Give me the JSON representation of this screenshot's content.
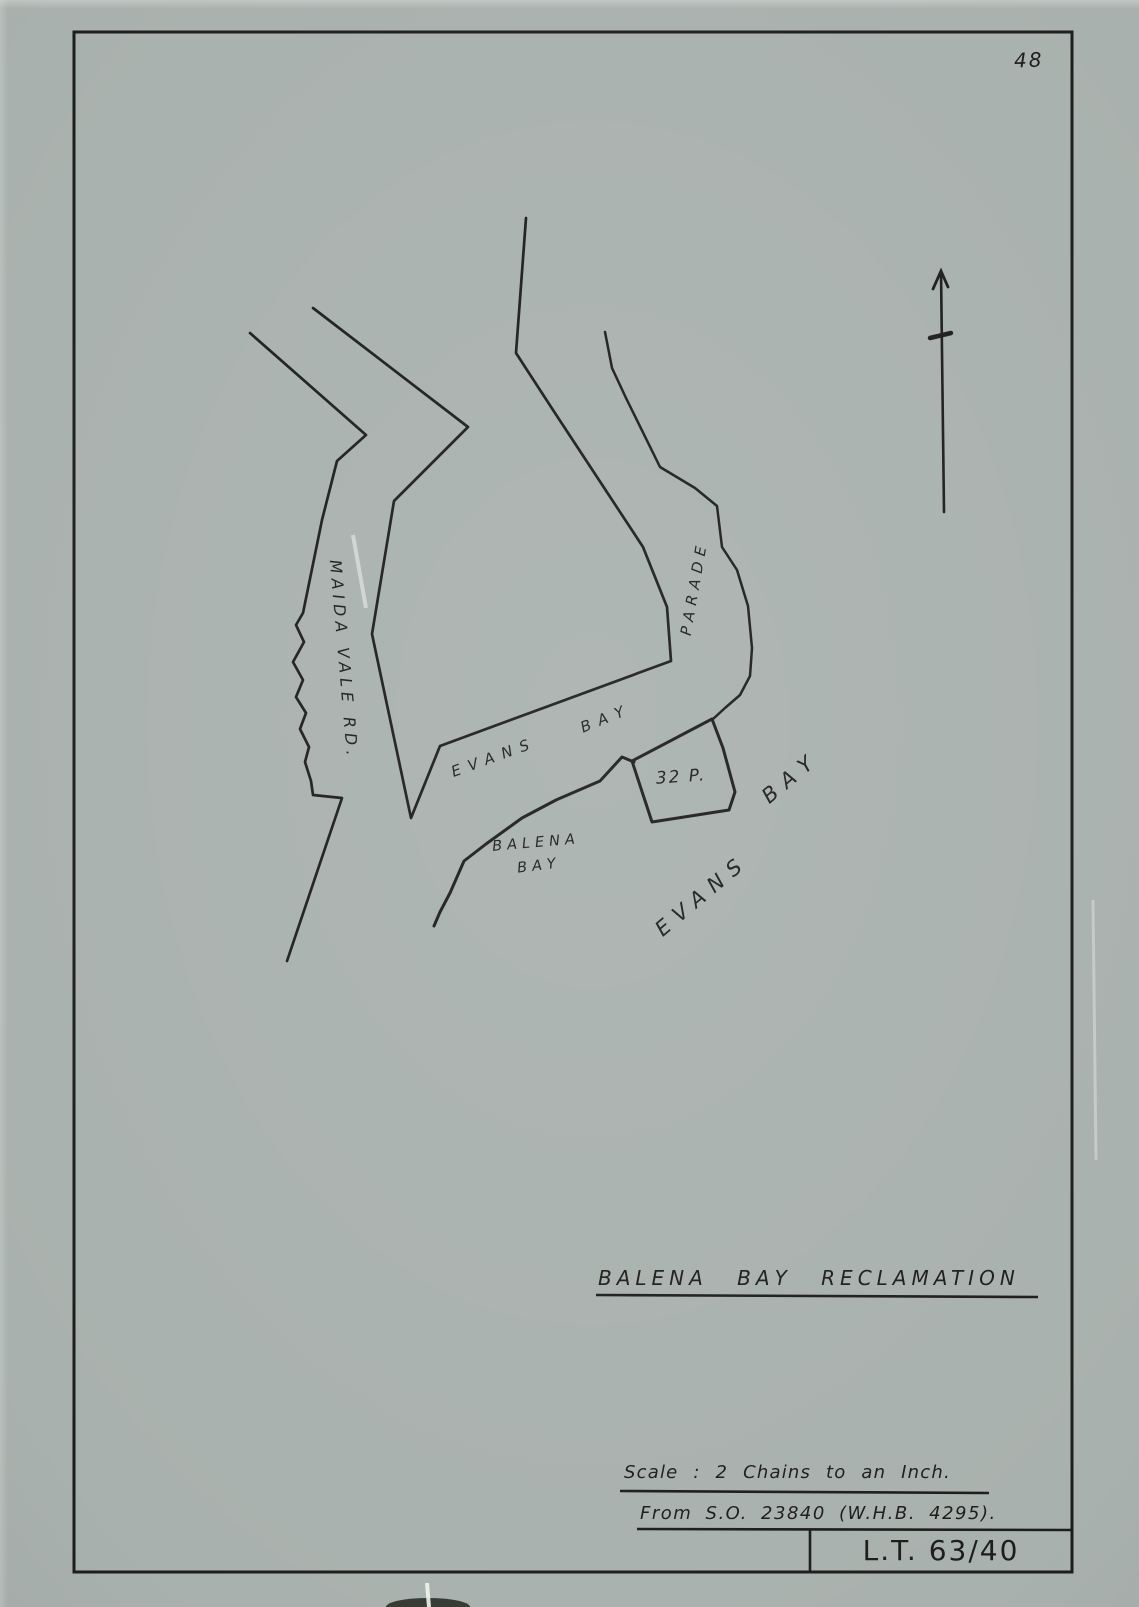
{
  "page": {
    "number": "48"
  },
  "map": {
    "labels": {
      "maida_vale_rd": "MAIDA VALE RD.",
      "evans_bay_shore_evans": "EVANS",
      "evans_bay_shore_bay": "BAY",
      "parade": "PARADE",
      "parcel_32p": "32 P.",
      "balena_bay_line1": "BALENA",
      "balena_bay_line2": "BAY",
      "evans_bay_water_evans": "EVANS",
      "evans_bay_water_bay": "BAY"
    },
    "icons": {
      "north_arrow": "north-arrow-icon"
    }
  },
  "title_block": {
    "title": "BALENA BAY RECLAMATION",
    "scale": "Scale : 2 Chains to an Inch.",
    "source": "From S.O. 23840 (W.H.B. 4295).",
    "plan_ref": "L.T. 63/40"
  },
  "colors": {
    "paper": "#a9b1ae",
    "ink": "#1d1d1b"
  }
}
